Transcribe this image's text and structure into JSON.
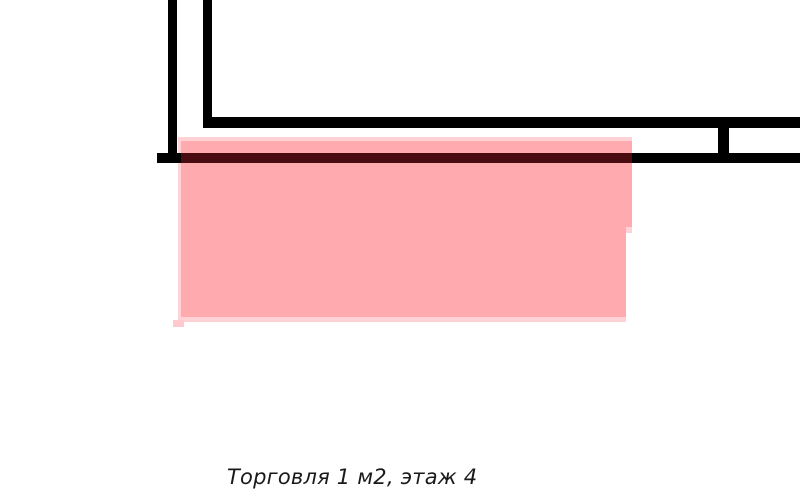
{
  "page": {
    "width": 800,
    "height": 497,
    "background": "#ffffff"
  },
  "caption": {
    "text": "Торговля 1 м2, этаж 4",
    "color": "#1a1a1a",
    "x": 227,
    "y": 465,
    "font_size": 21
  },
  "colors": {
    "wall": "#000000",
    "highlight": "#ffaaae",
    "highlight_fringe": "#ffd2d6",
    "highlight_tab": "#ffc9ce",
    "highlight_overlap_line": "#4a0b10",
    "background": "#ffffff"
  },
  "plan": {
    "shapes": [
      {
        "name": "highlight-fringe-top",
        "x": 178,
        "y": 137,
        "w": 454,
        "h": 6,
        "color": "#ffd2d6",
        "interactable": false
      },
      {
        "name": "highlight-fringe-left",
        "x": 178,
        "y": 140,
        "w": 4,
        "h": 179,
        "color": "#ffd2d6",
        "interactable": false
      },
      {
        "name": "highlight-main-upper",
        "x": 181,
        "y": 141,
        "w": 451,
        "h": 86,
        "color": "#ffaaae",
        "interactable": true
      },
      {
        "name": "highlight-main-lower",
        "x": 181,
        "y": 227,
        "w": 445,
        "h": 90,
        "color": "#ffaaae",
        "interactable": true
      },
      {
        "name": "highlight-step-light",
        "x": 626,
        "y": 227,
        "w": 6,
        "h": 6,
        "color": "#ffd2d6",
        "interactable": false
      },
      {
        "name": "highlight-fringe-bottom",
        "x": 178,
        "y": 317,
        "w": 448,
        "h": 5,
        "color": "#ffd2d6",
        "interactable": false
      },
      {
        "name": "highlight-tab",
        "x": 173,
        "y": 320,
        "w": 11,
        "h": 7,
        "color": "#ffc9ce",
        "interactable": false
      },
      {
        "name": "wall-vertical-left",
        "x": 168,
        "y": 0,
        "w": 9,
        "h": 162,
        "color": "#000000",
        "interactable": false
      },
      {
        "name": "wall-vertical-right",
        "x": 203,
        "y": 0,
        "w": 9,
        "h": 127,
        "color": "#000000",
        "interactable": false
      },
      {
        "name": "wall-horizontal-top",
        "x": 203,
        "y": 117,
        "w": 597,
        "h": 11,
        "color": "#000000",
        "interactable": false
      },
      {
        "name": "wall-connector",
        "x": 718,
        "y": 117,
        "w": 11,
        "h": 46,
        "color": "#000000",
        "interactable": false
      },
      {
        "name": "wall-horizontal-bottom-left",
        "x": 157,
        "y": 153,
        "w": 24,
        "h": 10,
        "color": "#000000",
        "interactable": false
      },
      {
        "name": "wall-bottom-overlap-segment",
        "x": 181,
        "y": 153,
        "w": 451,
        "h": 10,
        "color": "#4a0b10",
        "interactable": false
      },
      {
        "name": "wall-horizontal-bottom-right",
        "x": 632,
        "y": 153,
        "w": 168,
        "h": 10,
        "color": "#000000",
        "interactable": false
      }
    ]
  }
}
